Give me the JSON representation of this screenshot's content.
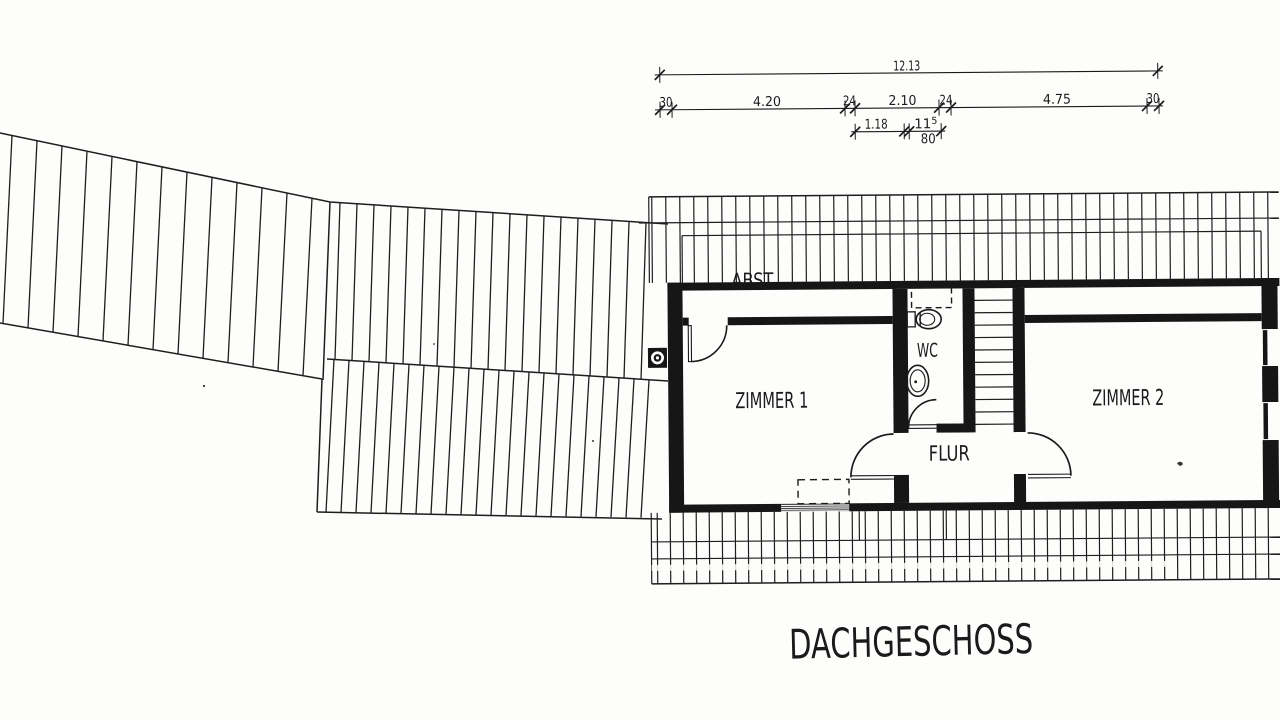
{
  "drawing": {
    "title": "DACHGESCHOSS",
    "room_labels": {
      "abst": "ABST",
      "wc": "WC",
      "flur": "FLUR",
      "zimmer1": "ZIMMER 1",
      "zimmer2": "ZIMMER 2"
    },
    "dimensions": {
      "total": "12.13",
      "segments": [
        "30",
        "4.20",
        "24",
        "2.10",
        "24",
        "4.75",
        "30"
      ],
      "sub": {
        "a": "1.18",
        "b_main": "11",
        "b_sup": "5",
        "c": "80"
      }
    },
    "ink_color": "#1c1c1c",
    "paper_color": "#fdfdfc"
  }
}
